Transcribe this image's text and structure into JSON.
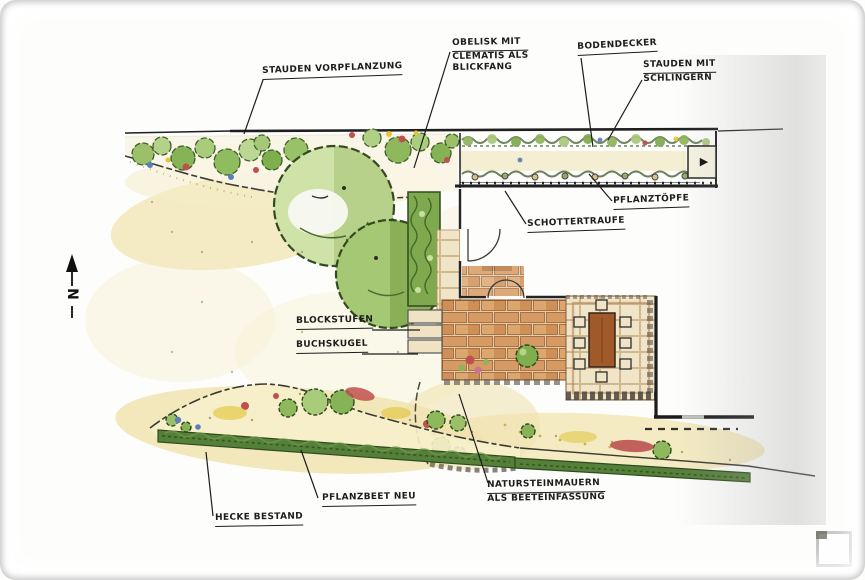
{
  "labels": {
    "stauden_vorpflanzung": "STAUDEN VORPFLANZUNG",
    "obelisk_line1": "OBELISK MIT",
    "obelisk_line2": "CLEMATIS ALS",
    "obelisk_line3": "BLICKFANG",
    "bodendecker": "BODENDECKER",
    "stauden_mit_line1": "STAUDEN MIT",
    "stauden_mit_line2": "SCHLINGERN",
    "pflanztoepfe": "PFLANZTÖPFE",
    "schottertraufe": "SCHOTTERTRAUFE",
    "blockstufen": "BLOCKSTUFEN",
    "buchskugel": "BUCHSKUGEL",
    "natursteinmauern_line1": "NATURSTEINMAUERN",
    "natursteinmauern_line2": "ALS BEETEINFASSUNG",
    "pflanzbeet_neu": "PFLANZBEET NEU",
    "hecke_bestand": "HECKE BESTAND"
  },
  "compass": {
    "letter": "N"
  },
  "icons": {
    "gate_arrow": "▶",
    "corner_icon": "image-placeholder-icon"
  },
  "colors": {
    "ink": "#242424",
    "tree_green_light": "#cfe3a8",
    "tree_green": "#a5c874",
    "hedge_green": "#55803a",
    "brick": "#d69a64",
    "lawn_cream": "#f2e7bd",
    "flower_red": "#c0504d",
    "flower_blue": "#5b7fbb",
    "flower_yellow": "#e6c437",
    "table_brown": "#a05a2a"
  }
}
